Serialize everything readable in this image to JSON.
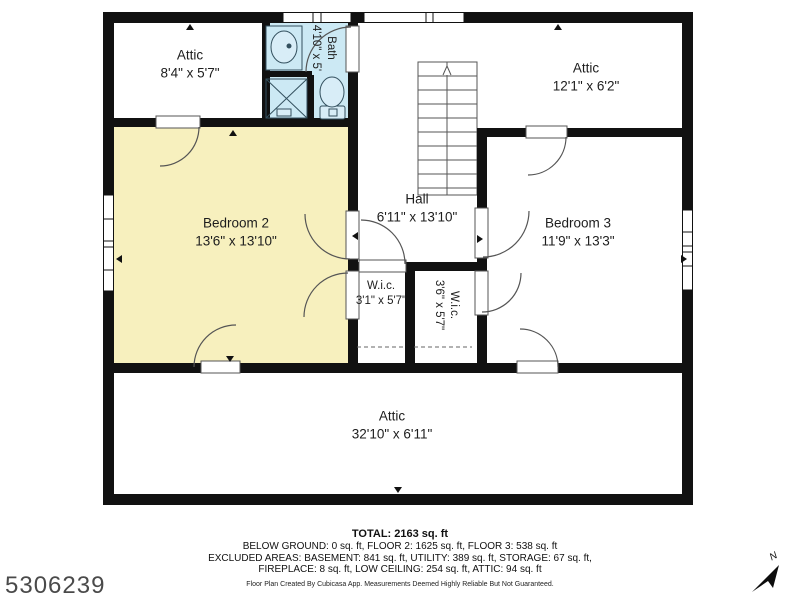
{
  "colors": {
    "wall": "#111111",
    "bedroom_fill": "#f7f0be",
    "bath_fill": "#cce9f4",
    "door_stroke": "#555555",
    "id_text": "#4a4a4a"
  },
  "rooms": {
    "attic_top_left": {
      "name": "Attic",
      "dims": "8'4\" x 5'7\""
    },
    "bath": {
      "name": "Bath",
      "dims": "4'10\" x 5'"
    },
    "attic_top_right": {
      "name": "Attic",
      "dims": "12'1\" x 6'2\""
    },
    "bedroom_2": {
      "name": "Bedroom 2",
      "dims": "13'6\" x 13'10\""
    },
    "hall": {
      "name": "Hall",
      "dims": "6'11\" x 13'10\""
    },
    "bedroom_3": {
      "name": "Bedroom 3",
      "dims": "11'9\" x 13'3\""
    },
    "wic_left": {
      "name": "W.i.c.",
      "dims": "3'1\" x 5'7\""
    },
    "wic_right": {
      "name": "W.i.c.",
      "dims": "3'6\" x 5'7\""
    },
    "attic_bottom": {
      "name": "Attic",
      "dims": "32'10\" x 6'11\""
    }
  },
  "footer": {
    "total": "TOTAL: 2163 sq. ft",
    "line1": "BELOW GROUND: 0 sq. ft, FLOOR 2: 1625 sq. ft, FLOOR 3: 538 sq. ft",
    "line2": "EXCLUDED AREAS: BASEMENT: 841 sq. ft, UTILITY: 389 sq. ft, STORAGE: 67 sq. ft,",
    "line3": "FIREPLACE: 8 sq. ft, LOW CEILING: 254 sq. ft, ATTIC: 94 sq. ft",
    "disclaimer": "Floor Plan Created By Cubicasa App. Measurements Deemed Highly Reliable But Not Guaranteed."
  },
  "listing_id": "5306239",
  "compass": {
    "north_label": "N"
  }
}
